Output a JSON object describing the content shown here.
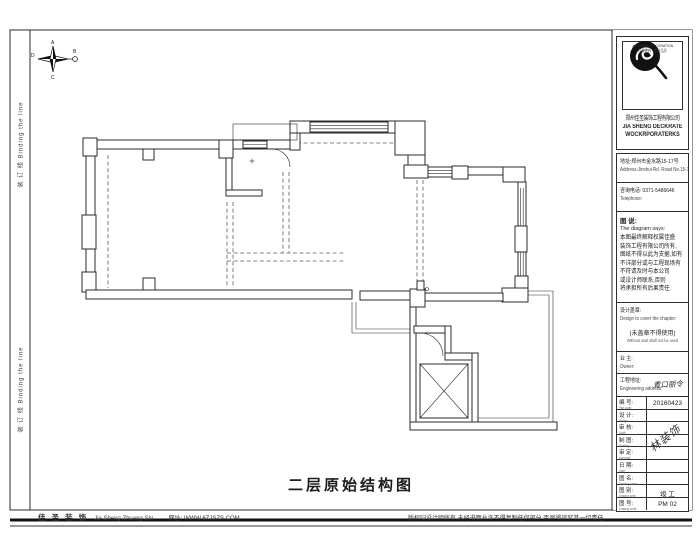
{
  "colors": {
    "line": "#2b2b2b",
    "paper": "#ffffff",
    "window_gray": "#c3c3c3"
  },
  "compass": {
    "n": "A",
    "e": "B",
    "s": "C",
    "w": "D"
  },
  "binding": {
    "label": "装 订 线  Binding the line"
  },
  "plan": {
    "title": "二层原始结构图"
  },
  "footer": {
    "left_cn": "佳 圣 装 饰",
    "left_en": "Jia Sheng Zhuang Shi",
    "left_site": "网址: WWW.6ZJSZS.COM",
    "right": "版权归设计师所有,未经书面允许不得复制任何部分,否则将追究其一切责任."
  },
  "panel": {
    "logo": {
      "caption": "JIA SHENG DECORATION",
      "sub": "佳圣装饰 · 专业品质",
      "company_cn": "郑州佳圣装饰工程有限公司",
      "company_en1": "JIA SHENG DECKRATE",
      "company_en2": "WOCKRPORATERKS"
    },
    "address": {
      "cn": "地址:郑州市金水路15-17号",
      "en": "Address:Jinshui Rd. Road No.15-17"
    },
    "phone": {
      "cn": "咨询电话:  0371-5486646",
      "en": "Telephone:"
    },
    "note": {
      "title_cn": "图 说:",
      "title_en": "The diagram says:",
      "lines": [
        "本图最终解释权属佳盛",
        "装饰工程有限公司所有,",
        "图纸不得以此为支据,如有",
        "不详部分或与工程现场有",
        "不符请及时与本公司",
        "或设计师联系,否则",
        "将承担所有后果责任."
      ]
    },
    "stamp": {
      "title_cn": "设计盖章:",
      "title_en": "Design to cover the chapter:",
      "warn_cn": "(未盖章不得使用)",
      "warn_en": "Without seal shall not be used"
    },
    "owner": {
      "label_cn": "业 主:",
      "label_en": "Owner:"
    },
    "project": {
      "label_cn": "工程地址:",
      "label_en": "Engineering address:",
      "value": "青口丽令"
    },
    "table": {
      "signature": "林装饰",
      "rows": [
        {
          "cn": "编 号:",
          "en": "Part code:",
          "value": "20160423"
        },
        {
          "cn": "设 计:",
          "en": "Design:",
          "value": ""
        },
        {
          "cn": "审 核:",
          "en": "Audit:",
          "value": ""
        },
        {
          "cn": "制 图:",
          "en": "Drafting:",
          "value": ""
        },
        {
          "cn": "审 定:",
          "en": "Approval:",
          "value": ""
        },
        {
          "cn": "日 期:",
          "en": "Date:",
          "value": ""
        },
        {
          "cn": "图 名:",
          "en": "Drawing name:",
          "value": ""
        },
        {
          "cn": "图 别:",
          "en": "Drawing type:",
          "value": "竣 工"
        },
        {
          "cn": "图 号:",
          "en": "Drawing code:",
          "value": "PM 02"
        }
      ]
    }
  }
}
